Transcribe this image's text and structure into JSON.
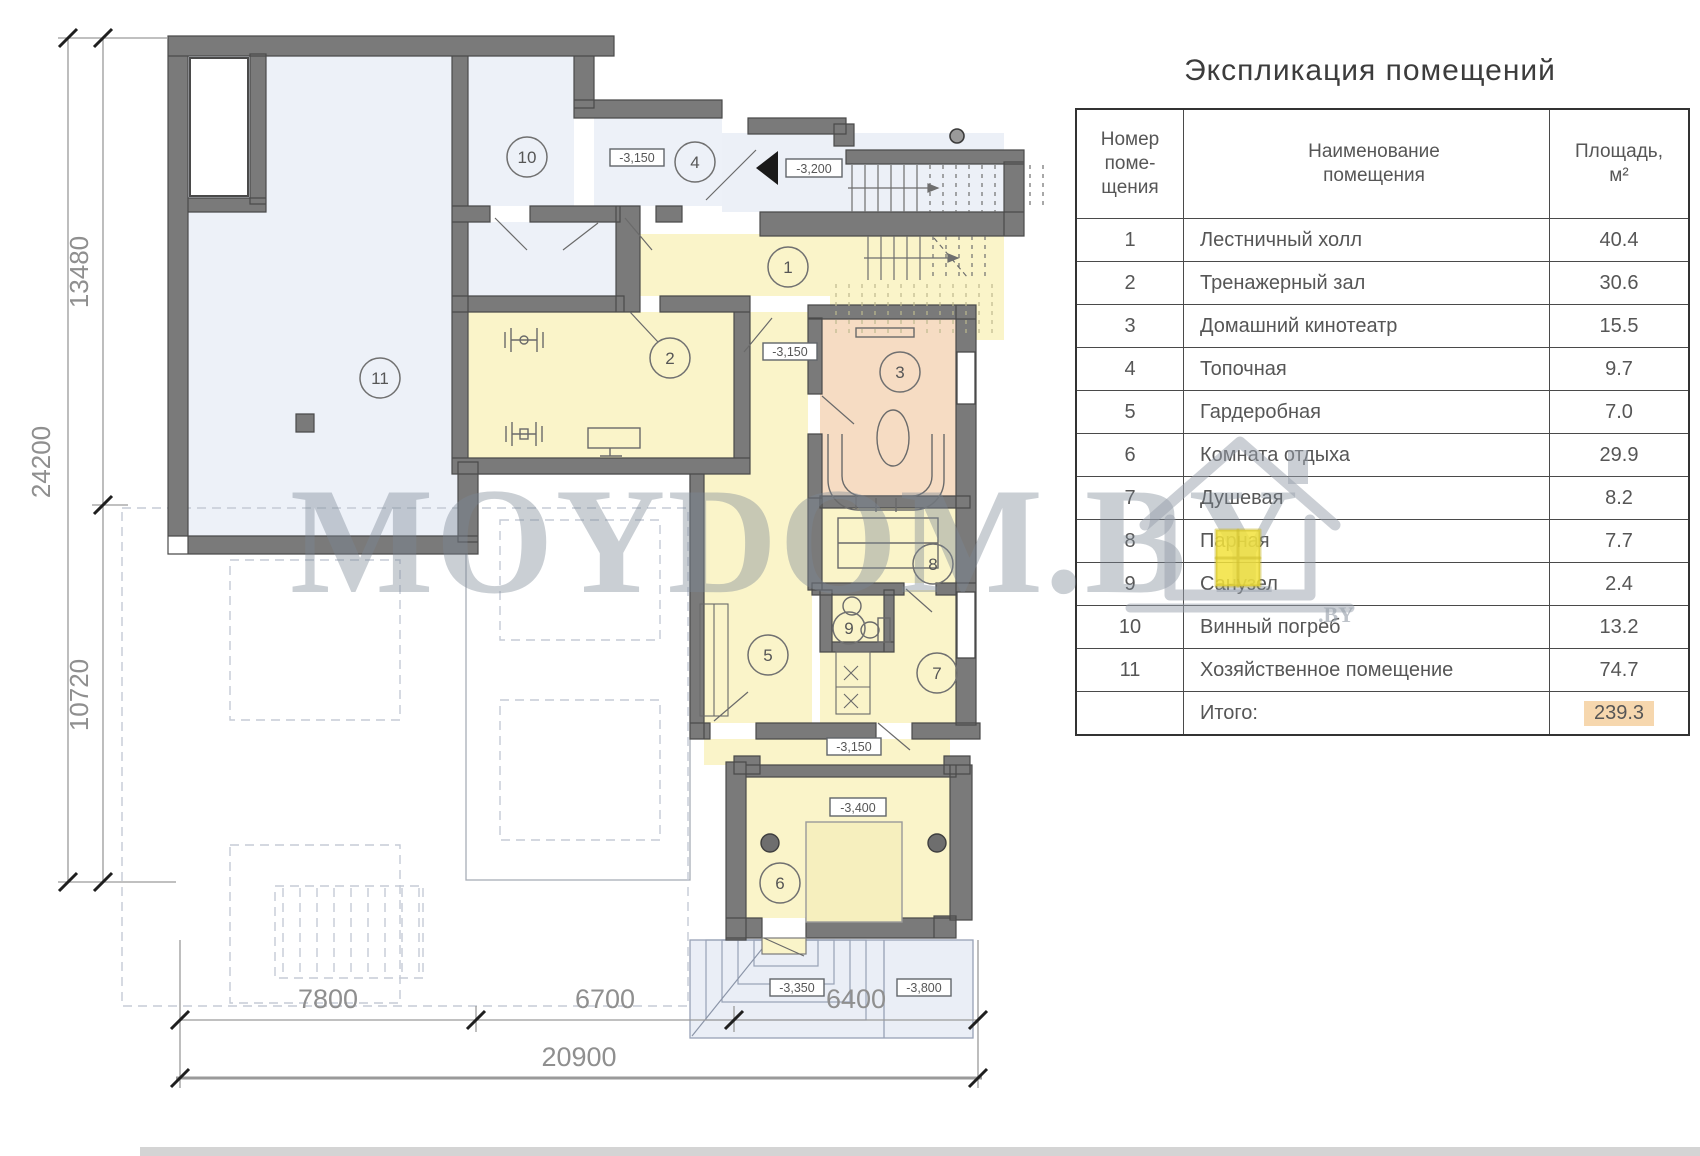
{
  "page": {
    "title_heading": "Экспликация помещений"
  },
  "table": {
    "col_num_header": "Номер\nпоме-\nщения",
    "col_name_header": "Наименование\nпомещения",
    "col_area_header": "Площадь,\nм²",
    "rows": [
      {
        "num": "1",
        "name": "Лестничный холл",
        "area": "40.4"
      },
      {
        "num": "2",
        "name": "Тренажерный зал",
        "area": "30.6"
      },
      {
        "num": "3",
        "name": "Домашний кинотеатр",
        "area": "15.5"
      },
      {
        "num": "4",
        "name": "Топочная",
        "area": "9.7"
      },
      {
        "num": "5",
        "name": "Гардеробная",
        "area": "7.0"
      },
      {
        "num": "6",
        "name": "Комната отдыха",
        "area": "29.9"
      },
      {
        "num": "7",
        "name": "Душевая",
        "area": "8.2"
      },
      {
        "num": "8",
        "name": "Парная",
        "area": "7.7"
      },
      {
        "num": "9",
        "name": "Санузел",
        "area": "2.4"
      },
      {
        "num": "10",
        "name": "Винный погреб",
        "area": "13.2"
      },
      {
        "num": "11",
        "name": "Хозяйственное помещение",
        "area": "74.7"
      }
    ],
    "total_label": "Итого:",
    "total_value": "239.3"
  },
  "plan": {
    "room_markers": {
      "m1": "1",
      "m2": "2",
      "m3": "3",
      "m4": "4",
      "m5": "5",
      "m6": "6",
      "m7": "7",
      "m8": "8",
      "m9": "9",
      "m10": "10",
      "m11": "11"
    },
    "elevations": {
      "e_3150": "-3,150",
      "e_3200": "-3,200",
      "e_3400": "-3,400",
      "e_3350": "-3,350",
      "e_3800": "-3,800"
    },
    "dimensions": {
      "left_upper": "13480",
      "left_lower": "10720",
      "left_total": "24200",
      "bottom_seg1": "7800",
      "bottom_seg2": "6700",
      "bottom_seg3": "6400",
      "bottom_total": "20900"
    }
  },
  "watermark": {
    "text": "MOYDOM.BY",
    "suffix": ".BY"
  },
  "colors": {
    "room_yellow": "#faf4c9",
    "room_blue": "#edf1f8",
    "room_peach": "#f6dcc3",
    "wall": "#7a7a7a",
    "total_highlight": "#f6d7ae",
    "terrace": "#eaeef6"
  }
}
